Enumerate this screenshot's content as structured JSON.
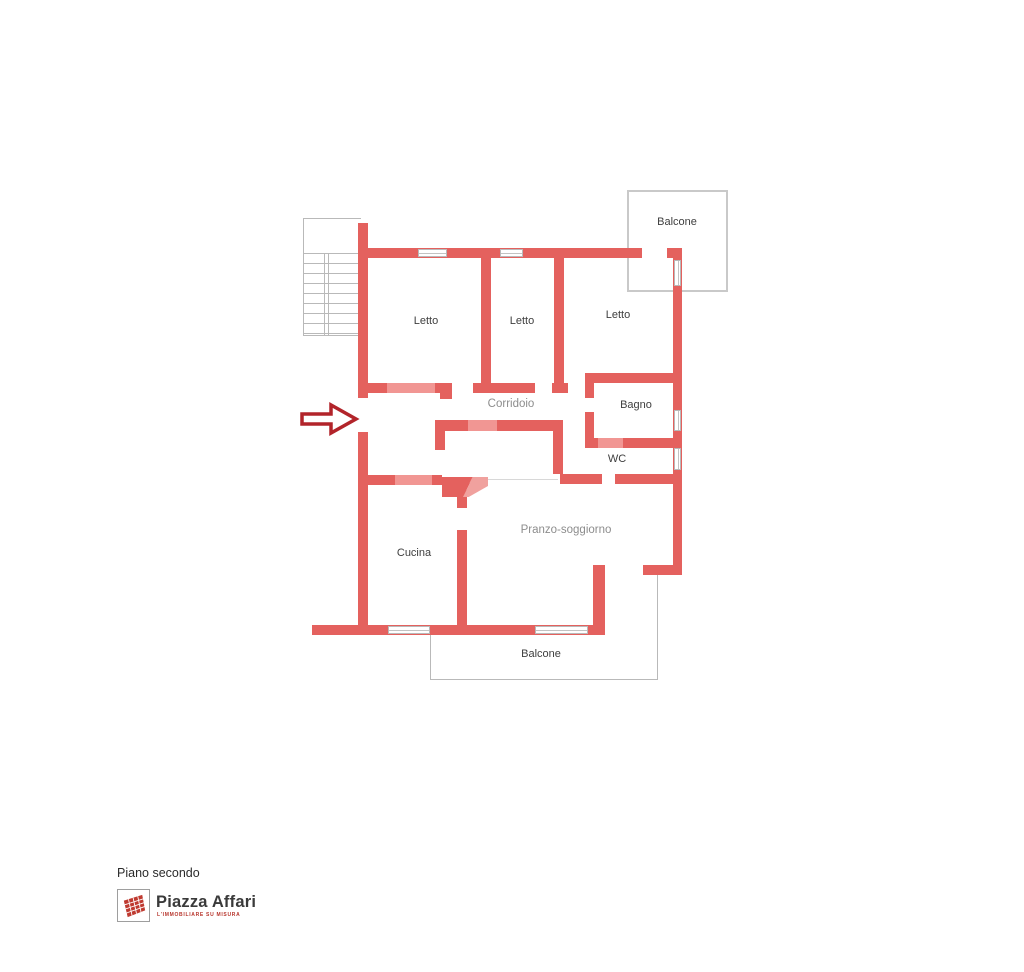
{
  "plan": {
    "labels": {
      "bedroom1": "Letto",
      "bedroom2": "Letto",
      "bedroom3": "Letto",
      "corridor": "Corridoio",
      "bathroom": "Bagno",
      "wc": "WC",
      "living_dining": "Pranzo-soggiorno",
      "kitchen": "Cucina",
      "balcony_top": "Balcone",
      "balcony_bottom": "Balcone"
    },
    "colors": {
      "wall": "#e4615e",
      "door": "#f19693",
      "arrow_outline": "#b2242a",
      "gray_outline": "#c9c9c9",
      "label_dark": "#3e3e3e",
      "label_light": "#8d8d8d"
    }
  },
  "footer": {
    "floor_label": "Piano secondo",
    "brand_name": "Piazza Affari",
    "brand_tagline": "L'IMMOBILIARE SU MISURA",
    "logo_color": "#bf3a30"
  }
}
